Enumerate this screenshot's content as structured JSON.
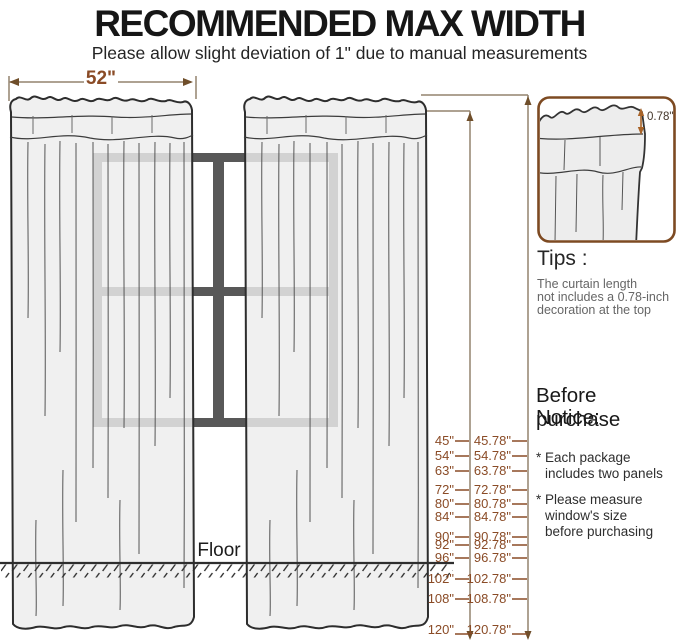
{
  "header": {
    "title": "RECOMMENDED MAX WIDTH",
    "subtitle": "Please allow slight deviation of 1\" due to manual measurements"
  },
  "diagram": {
    "panel_width_label": "52\"",
    "floor_label": "Floor",
    "length_rows": [
      {
        "length": "45\"",
        "total": "45.78\""
      },
      {
        "length": "54\"",
        "total": "54.78\""
      },
      {
        "length": "63\"",
        "total": "63.78\""
      },
      {
        "length": "72\"",
        "total": "72.78\""
      },
      {
        "length": "80\"",
        "total": "80.78\""
      },
      {
        "length": "84\"",
        "total": "84.78\""
      },
      {
        "length": "90\"",
        "total": "90.78\""
      },
      {
        "length": "92\"",
        "total": "92.78\""
      },
      {
        "length": "96\"",
        "total": "96.78\""
      },
      {
        "length": "102\"",
        "total": "102.78\""
      },
      {
        "length": "108\"",
        "total": "108.78\""
      },
      {
        "length": "120\"",
        "total": "120.78\""
      }
    ]
  },
  "inset": {
    "decoration_height_label": "0.78\""
  },
  "tips": {
    "heading": "Tips :",
    "lines": [
      "The curtain length",
      "not includes a 0.78-inch",
      "decoration at the top"
    ]
  },
  "notice": {
    "heading_lines": [
      "Before purchase",
      "Notice:"
    ],
    "bullet1_lines": [
      "* Each package",
      "includes two panels"
    ],
    "bullet2_lines": [
      "* Please measure",
      "window's size",
      "before purchasing"
    ]
  },
  "colors": {
    "accent_text": "#8a4b26",
    "dimension_line": "#93836f",
    "window_frame": "#585858",
    "curtain_fill": "#ededed",
    "inset_border": "#7d4a22",
    "floor_line": "#2e2e2e"
  }
}
